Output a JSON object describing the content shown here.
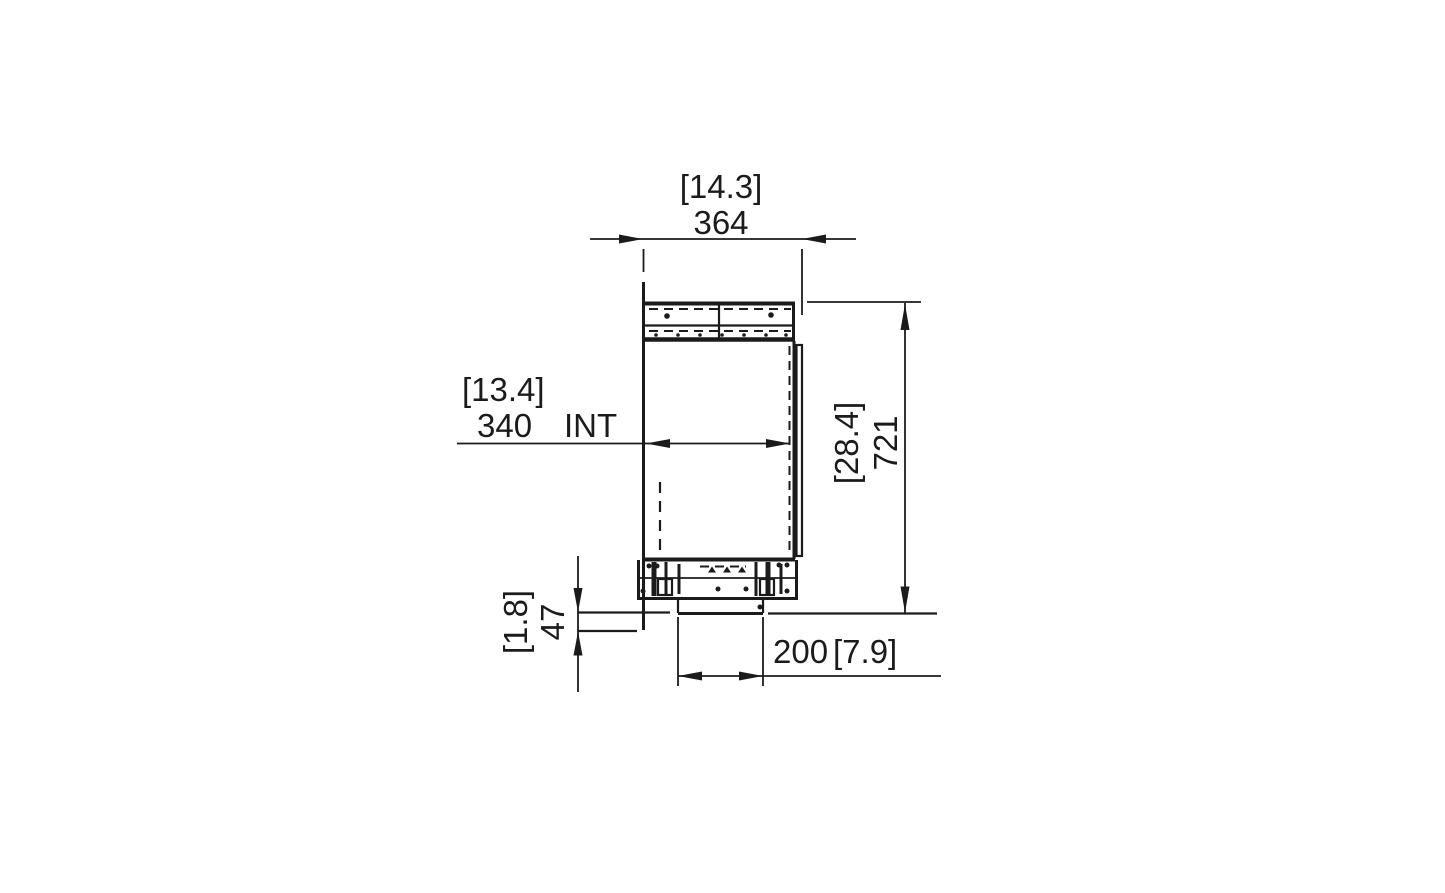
{
  "page": {
    "background": "#ffffff",
    "line_color": "#1b1b1b",
    "drawing_type": "technical-section-drawing"
  },
  "drawing": {
    "dims": {
      "overall_width": {
        "imperial": "[14.3]",
        "metric": "364"
      },
      "internal_width": {
        "imperial": "[13.4]",
        "metric": "340",
        "suffix": "INT"
      },
      "overall_height": {
        "imperial": "[28.4]",
        "metric": "721"
      },
      "base_recess": {
        "imperial": "[1.8]",
        "metric": "47"
      },
      "base_width": {
        "metric": "200",
        "imperial": "[7.9]"
      }
    }
  }
}
